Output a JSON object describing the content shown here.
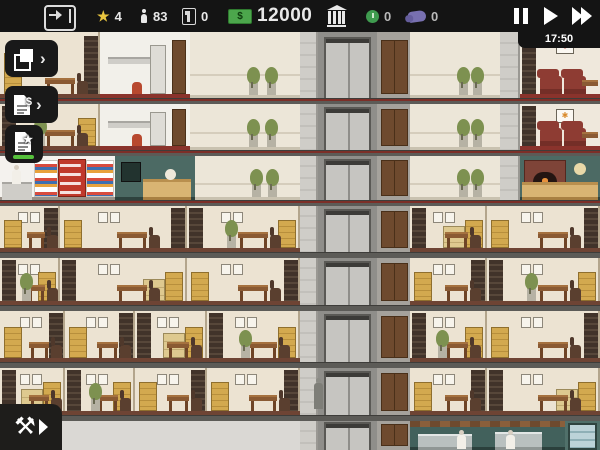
{
  "hud": {
    "exit": {
      "icon": "exit-door-icon"
    },
    "prestige": {
      "icon": "star-icon",
      "value": "4",
      "color": "#e9c53f"
    },
    "population": {
      "icon": "person-icon",
      "value": "83"
    },
    "vacancies": {
      "icon": "unit-flag-icon",
      "value": "0"
    },
    "money": {
      "icon": "cash-bill-icon",
      "value": "12000",
      "color": "#4ca64c"
    },
    "bank": {
      "icon": "bank-icon"
    },
    "contracts": {
      "icon": "clock-coin-icon",
      "value": "0",
      "color": "#3f9b4f"
    },
    "deals": {
      "icon": "handshake-icon",
      "value": "0",
      "color": "#837bc1"
    },
    "speed": {
      "pause": "pause-icon",
      "play": "play-icon",
      "ffwd": "fast-forward-icon"
    },
    "clock": {
      "time": "17:50"
    }
  },
  "side_toolbar": {
    "buttons": [
      {
        "id": "copy-tool",
        "icon": "copy-pages-icon",
        "chevron": "›",
        "active": false
      },
      {
        "id": "finances-report",
        "icon": "invoice-dollar-icon",
        "chevron": "›",
        "active": false
      },
      {
        "id": "contracts-report",
        "icon": "document-star-icon",
        "chevron": "",
        "active": true,
        "indicator_color": "#56c13c"
      }
    ]
  },
  "build_menu": {
    "icon": "hammer-wrench-icon",
    "glyph": "⚒"
  },
  "building": {
    "slabs": [
      {
        "y": 98,
        "red": true
      },
      {
        "y": 150,
        "red": true
      },
      {
        "y": 200,
        "red": true
      },
      {
        "y": 252,
        "red": false
      },
      {
        "y": 305,
        "red": false
      },
      {
        "y": 362,
        "red": false
      },
      {
        "y": 415,
        "red": false
      }
    ],
    "floors": [
      {
        "y": 32,
        "h": 66,
        "rooms": [
          {
            "t": "office",
            "x": 0,
            "w": 100,
            "v": 0
          },
          {
            "t": "medical",
            "x": 100,
            "w": 90
          },
          {
            "t": "empty",
            "x": 190,
            "w": 110,
            "plants": true
          },
          {
            "t": "wall",
            "x": 300,
            "w": 18
          },
          {
            "t": "shaft",
            "x": 318,
            "w": 59
          },
          {
            "t": "doors",
            "x": 377,
            "w": 33
          },
          {
            "t": "empty",
            "x": 410,
            "w": 90,
            "plants": true
          },
          {
            "t": "wall",
            "x": 500,
            "w": 20
          },
          {
            "t": "waiting",
            "x": 520,
            "w": 80,
            "art": "lips"
          }
        ]
      },
      {
        "y": 103,
        "h": 47,
        "rooms": [
          {
            "t": "office",
            "x": 0,
            "w": 100,
            "v": 1
          },
          {
            "t": "medical",
            "x": 100,
            "w": 90
          },
          {
            "t": "empty",
            "x": 190,
            "w": 110,
            "plants": true
          },
          {
            "t": "wall",
            "x": 300,
            "w": 18
          },
          {
            "t": "shaft",
            "x": 318,
            "w": 59
          },
          {
            "t": "doors",
            "x": 377,
            "w": 33
          },
          {
            "t": "empty",
            "x": 410,
            "w": 90,
            "plants": true
          },
          {
            "t": "wall",
            "x": 500,
            "w": 20
          },
          {
            "t": "waiting",
            "x": 520,
            "w": 80,
            "art": "sun"
          }
        ]
      },
      {
        "y": 155,
        "h": 45,
        "rooms": [
          {
            "t": "deli",
            "x": 0,
            "w": 115
          },
          {
            "t": "cafe",
            "x": 115,
            "w": 80
          },
          {
            "t": "empty",
            "x": 195,
            "w": 105,
            "plants": true
          },
          {
            "t": "wall",
            "x": 300,
            "w": 18
          },
          {
            "t": "shaft",
            "x": 318,
            "w": 59
          },
          {
            "t": "doors",
            "x": 377,
            "w": 33
          },
          {
            "t": "empty",
            "x": 410,
            "w": 90,
            "plants": true
          },
          {
            "t": "wall",
            "x": 500,
            "w": 20
          },
          {
            "t": "bakery",
            "x": 520,
            "w": 80
          }
        ]
      },
      {
        "y": 205,
        "h": 47,
        "rooms": [
          {
            "t": "office",
            "x": 0,
            "w": 60,
            "v": 2
          },
          {
            "t": "office",
            "x": 60,
            "w": 127,
            "v": 0
          },
          {
            "t": "office",
            "x": 187,
            "w": 113,
            "v": 1
          },
          {
            "t": "wall",
            "x": 300,
            "w": 18
          },
          {
            "t": "shaft",
            "x": 318,
            "w": 59
          },
          {
            "t": "doors",
            "x": 377,
            "w": 33
          },
          {
            "t": "office",
            "x": 410,
            "w": 77,
            "v": 3
          },
          {
            "t": "office",
            "x": 487,
            "w": 113,
            "v": 0
          }
        ]
      },
      {
        "y": 257,
        "h": 48,
        "rooms": [
          {
            "t": "office",
            "x": 0,
            "w": 60,
            "v": 1
          },
          {
            "t": "office",
            "x": 60,
            "w": 127,
            "v": 3
          },
          {
            "t": "office",
            "x": 187,
            "w": 113,
            "v": 0
          },
          {
            "t": "wall",
            "x": 300,
            "w": 18
          },
          {
            "t": "shaft",
            "x": 318,
            "w": 59
          },
          {
            "t": "doors",
            "x": 377,
            "w": 33
          },
          {
            "t": "office",
            "x": 410,
            "w": 77,
            "v": 2
          },
          {
            "t": "office",
            "x": 487,
            "w": 113,
            "v": 1
          }
        ]
      },
      {
        "y": 310,
        "h": 52,
        "rooms": [
          {
            "t": "office",
            "x": 0,
            "w": 65,
            "v": 0
          },
          {
            "t": "office",
            "x": 65,
            "w": 70,
            "v": 2
          },
          {
            "t": "office",
            "x": 135,
            "w": 72,
            "v": 3
          },
          {
            "t": "office",
            "x": 207,
            "w": 93,
            "v": 1
          },
          {
            "t": "wall",
            "x": 300,
            "w": 18
          },
          {
            "t": "shaft",
            "x": 318,
            "w": 59
          },
          {
            "t": "doors",
            "x": 377,
            "w": 33
          },
          {
            "t": "office",
            "x": 410,
            "w": 77,
            "v": 1
          },
          {
            "t": "office",
            "x": 487,
            "w": 113,
            "v": 2
          }
        ]
      },
      {
        "y": 367,
        "h": 48,
        "rooms": [
          {
            "t": "office",
            "x": 0,
            "w": 65,
            "v": 3
          },
          {
            "t": "office",
            "x": 65,
            "w": 70,
            "v": 1
          },
          {
            "t": "office",
            "x": 135,
            "w": 72,
            "v": 0
          },
          {
            "t": "office",
            "x": 207,
            "w": 93,
            "v": 2
          },
          {
            "t": "wall",
            "x": 300,
            "w": 18
          },
          {
            "t": "shaft",
            "x": 318,
            "w": 59
          },
          {
            "t": "doors",
            "x": 377,
            "w": 33
          },
          {
            "t": "office",
            "x": 410,
            "w": 77,
            "v": 0
          },
          {
            "t": "office",
            "x": 487,
            "w": 113,
            "v": 3
          }
        ]
      },
      {
        "y": 420,
        "h": 30,
        "rooms": [
          {
            "t": "unbuilt",
            "x": 0,
            "w": 300
          },
          {
            "t": "wall",
            "x": 300,
            "w": 18
          },
          {
            "t": "shaft",
            "x": 318,
            "w": 59
          },
          {
            "t": "doors",
            "x": 377,
            "w": 33
          },
          {
            "t": "restaurant",
            "x": 410,
            "w": 155
          },
          {
            "t": "display",
            "x": 565,
            "w": 35
          }
        ]
      }
    ],
    "person": {
      "x": 314,
      "y": 378,
      "floor_note": "standing-at-elevator-lobby"
    }
  }
}
